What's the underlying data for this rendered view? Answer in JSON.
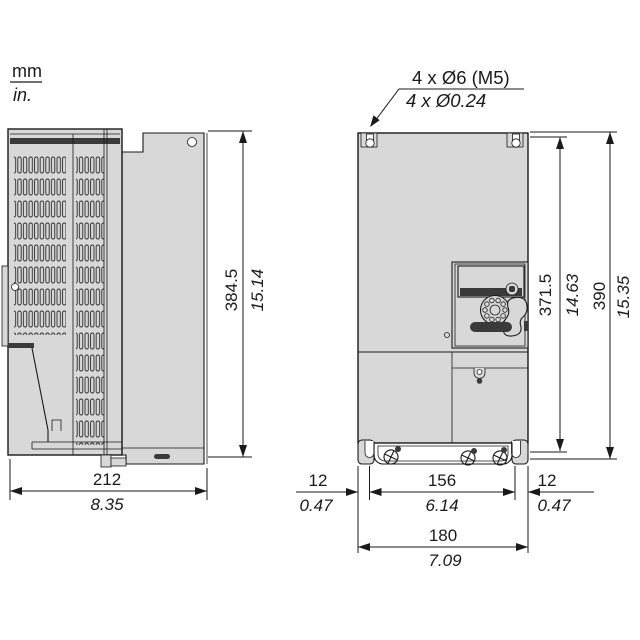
{
  "units": {
    "metric": "mm",
    "imperial": "in."
  },
  "callout": {
    "metric": "4 x Ø6 (M5)",
    "imperial": "4 x Ø0.24"
  },
  "side_view": {
    "height": {
      "mm": "384.5",
      "in": "15.14"
    },
    "depth": {
      "mm": "212",
      "in": "8.35"
    }
  },
  "front_view": {
    "mounting_height": {
      "mm": "371.5",
      "in": "14.63"
    },
    "total_height": {
      "mm": "390",
      "in": "15.35"
    },
    "left_offset": {
      "mm": "12",
      "in": "0.47"
    },
    "hole_spacing": {
      "mm": "156",
      "in": "6.14"
    },
    "right_offset": {
      "mm": "12",
      "in": "0.47"
    },
    "total_width": {
      "mm": "180",
      "in": "7.09"
    }
  },
  "colors": {
    "line": "#1a1a1a",
    "body_fill": "#d8d8d8",
    "dark_fill": "#3a3a3a"
  }
}
